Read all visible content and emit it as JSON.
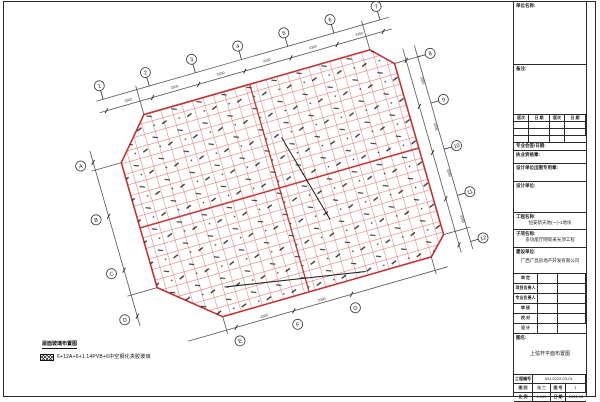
{
  "title_block": {
    "unit_label": "单位名称:",
    "notes_label": "备注:",
    "revision_headers": [
      "版次",
      "日 期",
      "版次",
      "日 期"
    ],
    "sign_row_label": "专业会签/日期:",
    "stamp_reg_label": "执业资格章:",
    "stamp_out_label": "设计单位出图专用章:",
    "design_unit_label": "设计单位:",
    "project_label": "工程名称:",
    "project_value": "恒安新天地(一)-1地块",
    "subproject_label": "子项名称:",
    "subproject_value": "多功能厅网架采光顶工程",
    "client_label": "建设单位:",
    "client_value": "广西广昌房地产开发有限公司",
    "signature_rows": [
      "审 定",
      "项目负责人",
      "专业负责人",
      "审 核",
      "校 对",
      "设 计"
    ],
    "drawing_name_label": "图名:",
    "drawing_name_value": "上弦杆平面布置图",
    "info": {
      "project_no_label": "工程编号",
      "project_no_value": "WJ-2022-03-01",
      "category_label": "图 别",
      "category_value": "施 工",
      "sheet_no_label": "图 号",
      "sheet_no_value": "1",
      "scale_label": "比 例",
      "scale_value": "1:100",
      "date_label": "日 期",
      "date_value": "2022.03"
    }
  },
  "plan": {
    "title": "屋面玻璃布置图",
    "legend_text": "6+12A+6+1.14PVB+6中空钢化夹胶玻璃",
    "dim_label": "3300",
    "grid_color": "#e06b6b",
    "outline_color": "#c23434",
    "top_bubbles": [
      "1",
      "2",
      "3",
      "4",
      "5",
      "6",
      "7"
    ],
    "right_bubbles": [
      "8",
      "9",
      "10",
      "11",
      "12"
    ],
    "left_bubbles": [
      "A",
      "B",
      "C",
      "D"
    ],
    "bottom_bubbles": [
      "E",
      "F",
      "G"
    ]
  }
}
